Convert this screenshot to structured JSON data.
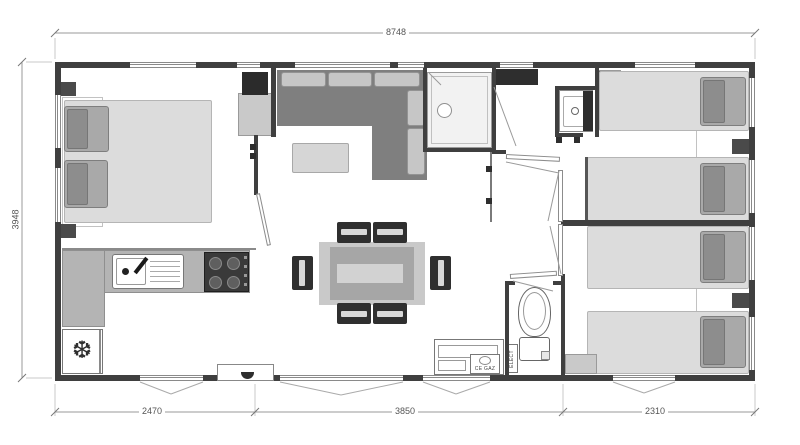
{
  "meta": {
    "type": "floor-plan",
    "subject": "mobile-home floor plan, top view"
  },
  "dimensions": {
    "top_width": "8748",
    "left_height": "3948",
    "bottom": [
      "2470",
      "3850",
      "2310"
    ]
  },
  "labels": {
    "gas_cabinet": "CE GAZ",
    "electric_cabinet": "ELECT"
  },
  "icons": {
    "fridge_snowflake": "❆"
  },
  "colors": {
    "wall": "#3f3f3f",
    "partition": "#7a7a7a",
    "bed": "#dcdcdc",
    "pillow": "#a9a9a9",
    "sofa": "#7f7f7f",
    "sofa_cushion": "#c6c6c6",
    "table_outer": "#c9c9c9",
    "table_inner": "#a6a6a6",
    "chair": "#2f2f2f",
    "counter": "#b4b4b4",
    "stove": "#3a3a3a",
    "shower_floor": "#f2f2f2",
    "dimension_line": "#9a9a9a",
    "dimension_text": "#555555"
  }
}
